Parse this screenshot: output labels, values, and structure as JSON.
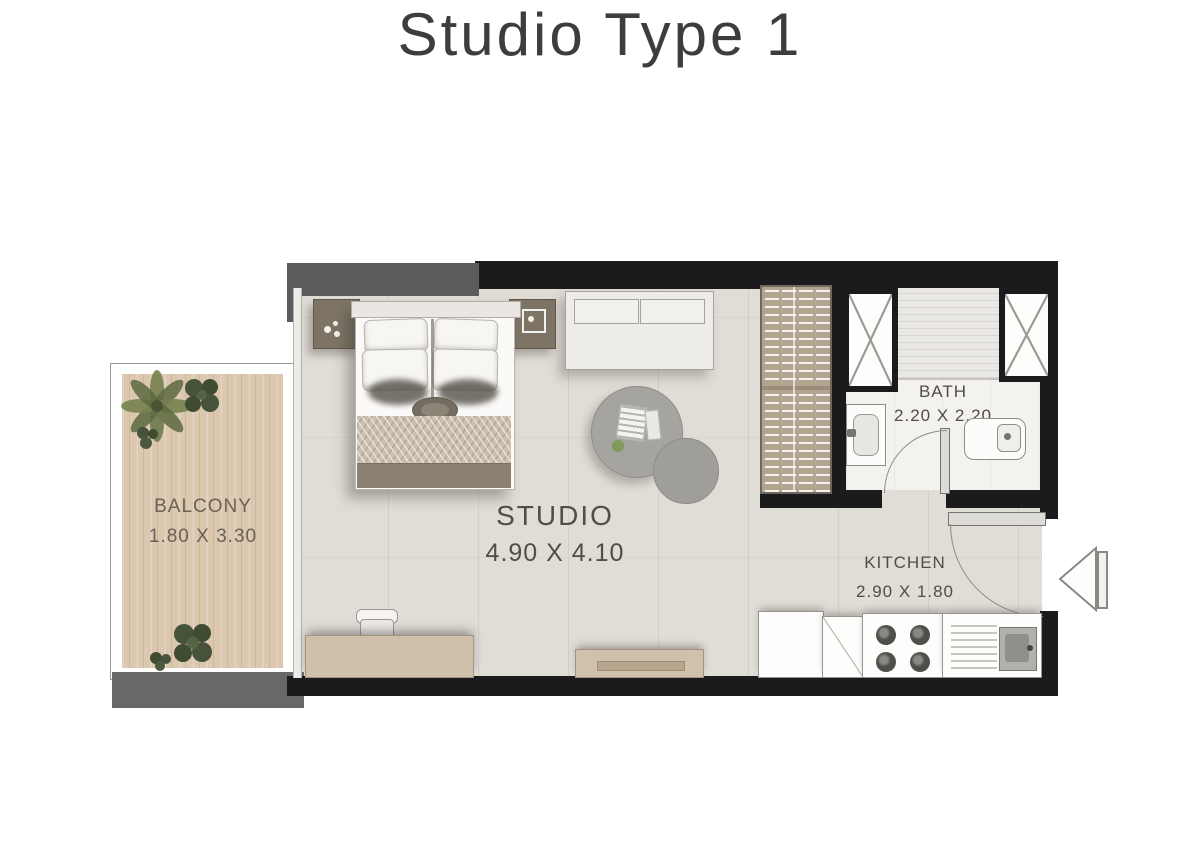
{
  "title": "Studio Type 1",
  "plan": {
    "balcony": {
      "label": "BALCONY",
      "dims": "1.80 X 3.30"
    },
    "studio": {
      "label": "STUDIO",
      "dims": "4.90 X 4.10"
    },
    "bath": {
      "label": "BATH",
      "dims": "2.20 X 2.20"
    },
    "kitchen": {
      "label": "KITCHEN",
      "dims": "2.90 X 1.80"
    }
  },
  "colors": {
    "wall_black": "#1b1b1d",
    "wall_gray": "#595b5d",
    "floor_tile": "#e0dcd6",
    "balcony_wood": "#dcc7af",
    "wardrobe_tan": "#b3a48f",
    "label_text": "#514d47",
    "title_text": "#3d3d3d"
  }
}
